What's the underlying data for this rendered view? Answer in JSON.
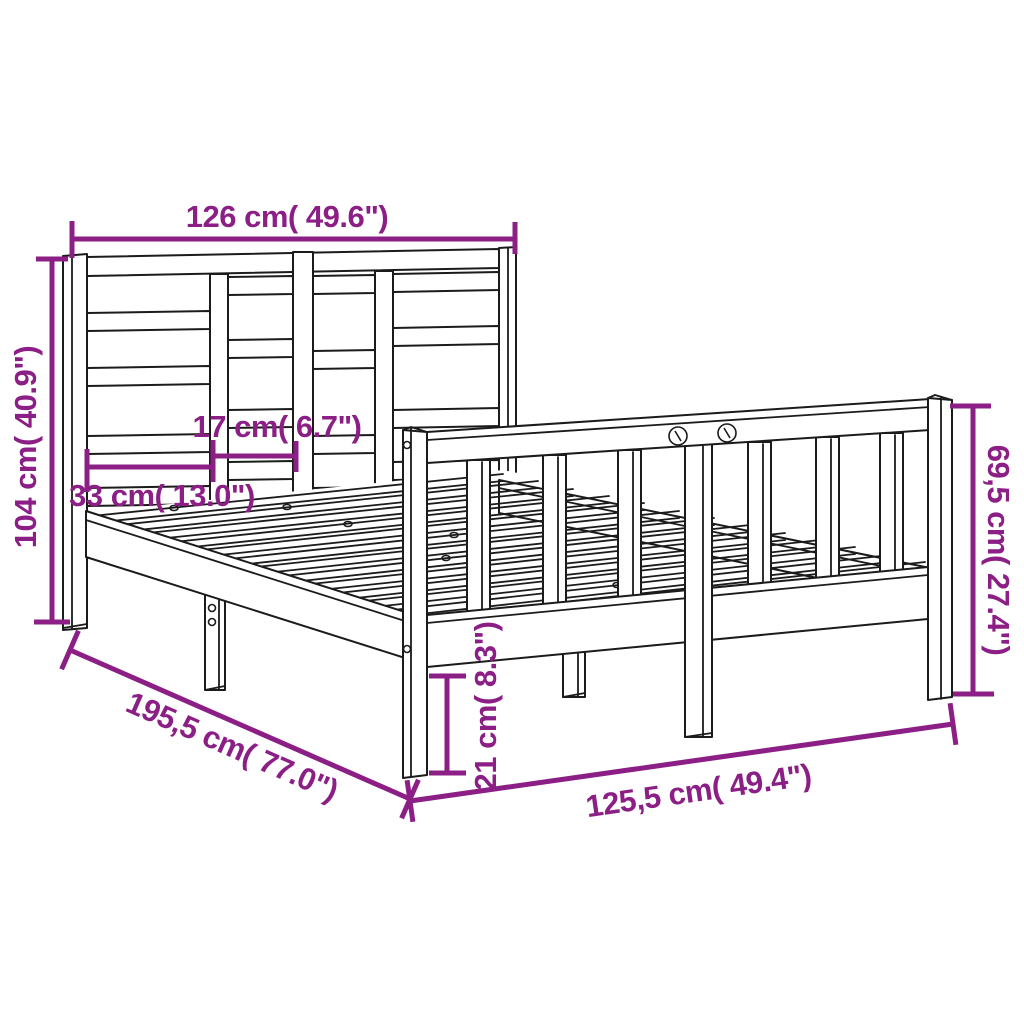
{
  "diagram": {
    "type": "product dimension line drawing",
    "subject": "wooden bed frame with slatted headboard, slat base and spindle footboard",
    "colors": {
      "dimension": "#8C1F86",
      "outline": "#1b1b1b",
      "background": "#ffffff"
    }
  },
  "dims": {
    "top_width": "126 cm( 49.6\")",
    "headboard_height": "104 cm( 40.9\")",
    "slat_spacing": "17 cm( 6.7\")",
    "slat_length": "33 cm( 13.0\")",
    "footboard_height": "69,5 cm( 27.4\")",
    "bed_length": "195,5 cm( 77.0\")",
    "bed_width": "125,5 cm( 49.4\")",
    "ground_clearance": "21 cm( 8.3\")"
  }
}
